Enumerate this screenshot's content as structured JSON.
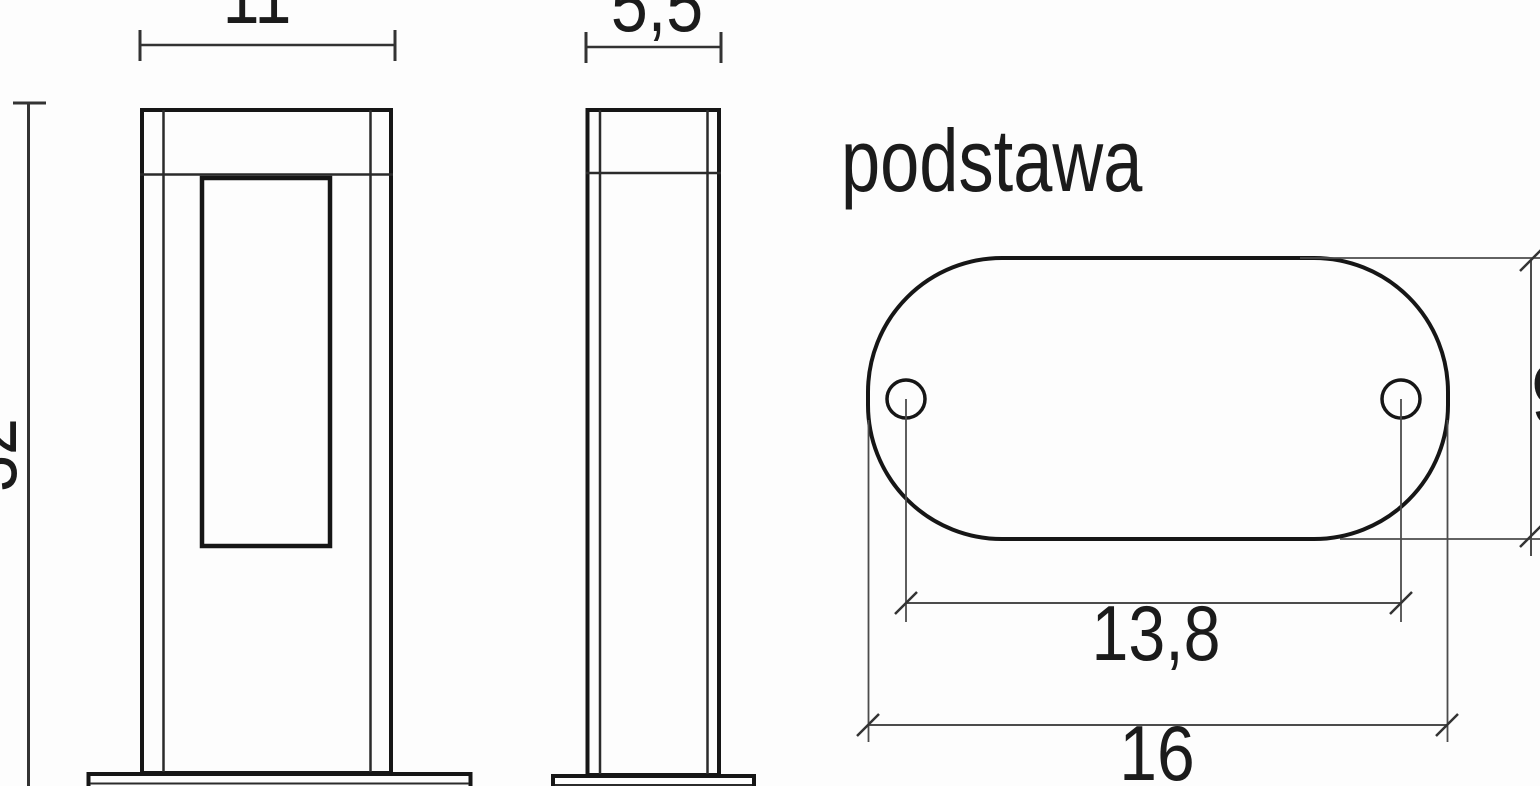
{
  "drawing": {
    "base_label": "podstawa",
    "front_width": "11",
    "side_depth": "5,5",
    "height_partial": "32",
    "base_hole_spacing": "13,8",
    "base_length": "16",
    "base_depth_partial": "9"
  },
  "colors": {
    "background": "#fdfdfd",
    "outline": "#161616",
    "dimension_line": "#4c4c4c",
    "tick": "#333333",
    "text": "#1b1b1b"
  }
}
